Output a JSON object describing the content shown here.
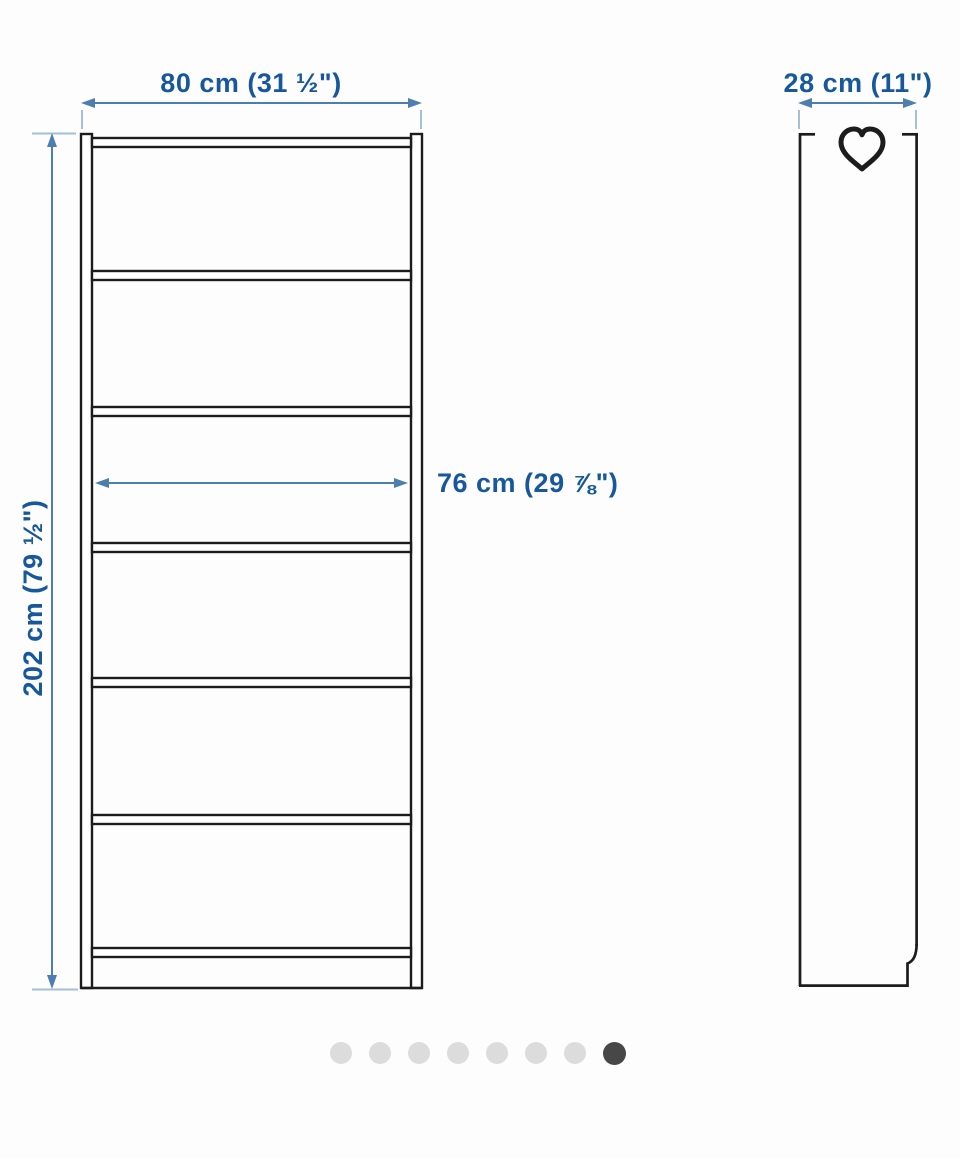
{
  "illustration": {
    "product": "bookcase-dimension-diagram",
    "front_view": {
      "width_label": "80 cm (31 ½\")",
      "height_label": "202 cm (79 ½\")",
      "inner_width_label": "76 cm (29 ⅞\")",
      "shelf_count": 6
    },
    "side_view": {
      "depth_label": "28 cm (11\")",
      "icon": "heart-outline"
    }
  },
  "carousel": {
    "dot_count": 8,
    "active_index": 7
  },
  "colors": {
    "background": "#fdfdfd",
    "drawing_line": "#1c1c1c",
    "dimension_text": "#17589c",
    "dimension_line": "#4c7eb0",
    "dimension_tick": "#a3c0d8",
    "dot_inactive": "#dcdcdc",
    "dot_active": "#474747"
  }
}
